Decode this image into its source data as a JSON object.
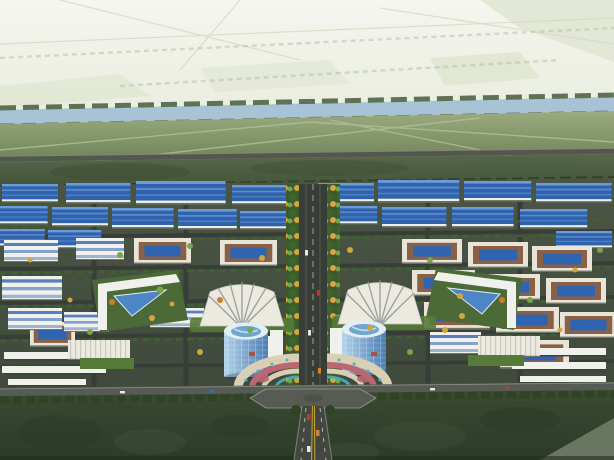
{
  "scene": {
    "title": "Aerial bird's-eye architectural rendering of an industrial park master plan",
    "type": "architectural-rendering",
    "regions": {
      "farmland": "Pale hazy farmland plain with faint field roads",
      "canal": "Canal with rows of trees along both banks",
      "fields": "Green buffer fields with footpaths",
      "highway": "East-west highway line",
      "greenBelt": "Tree belt north of the park",
      "industrialZone": "Grid of blue-roofed factory workshops and courtyard office buildings",
      "centralBoulevard": "Tree-lined central boulevard axis with traffic",
      "fanBuildingLeft": "Fan-shaped white exhibition building (west)",
      "fanBuildingRight": "Fan-shaped white exhibition building (east)",
      "towerLeft": "Cylindrical blue glass tower (west)",
      "towerRight": "Cylindrical blue glass tower (east)",
      "trianglePark": "Garden block with triangular glass-roof pavilion",
      "entrancePlaza": "Terraced semicircular entrance plaza with flower beds",
      "plazaIntersection": "Paved gateway intersection",
      "southRoad": "Southern boundary road with street trees",
      "forest": "Dark green forest belt in the foreground",
      "entranceRoad": "Main entrance road with yellow centre line and cars"
    }
  },
  "palette": {
    "farmPale": "#f2f4ec",
    "farmPatch": "#dfe5d0",
    "farmLine": "#d3dabf",
    "riverBlue": "#a9c3d6",
    "bankTree": "#5e7254",
    "fieldLight": "#9cab80",
    "fieldDark": "#6d8156",
    "pathLine": "#b3bf99",
    "highwayGray": "#53584f",
    "bandLight": "#57684a",
    "bandDark": "#415238",
    "hedgeDark": "#2e4424",
    "parkLight": "#4b5545",
    "parkDark": "#3f4a3c",
    "parkRoad": "#383e37",
    "parkLawn": "#567a38",
    "factoryRoof": "#2f63ad",
    "factoryRidge": "#6d9ad8",
    "factoryWall": "#eceee8",
    "wallShadow": "#565d55",
    "cream": "#e8e4d8",
    "brownRoof": "#8a6047",
    "glassBlue": "#2f64b0",
    "whiteBldg": "#f0f1ec",
    "slabGlass": "#3a6cb4",
    "treeGreen": "#3f6430",
    "treeLight": "#79a449",
    "treeYellow": "#d4a53e",
    "treeOrange": "#c8802f",
    "towerLight": "#b2d2e8",
    "towerDark": "#4a7cb4",
    "towerRim": "#e2eef5",
    "towerTopGlass": "#6fa6cf",
    "coreWhite": "#eef0ec",
    "fanWhite": "#eceade",
    "fanRib": "#8f959c",
    "plazaCream": "#d9cfb4",
    "plazaPink": "#bd6671",
    "plazaTeal": "#49b6c0",
    "pavilionRed": "#b0503c",
    "asphaltRoad": "#565b54",
    "curbLight": "#9aa091",
    "forestLight": "#46553b",
    "forestMid": "#37452f",
    "forestDark": "#2a3725",
    "wedgeGray": "#707d66",
    "yellowLine": "#c8a832",
    "carRed": "#c23a2e",
    "carWhite": "#e8e8e4",
    "carOrange": "#d88030"
  }
}
